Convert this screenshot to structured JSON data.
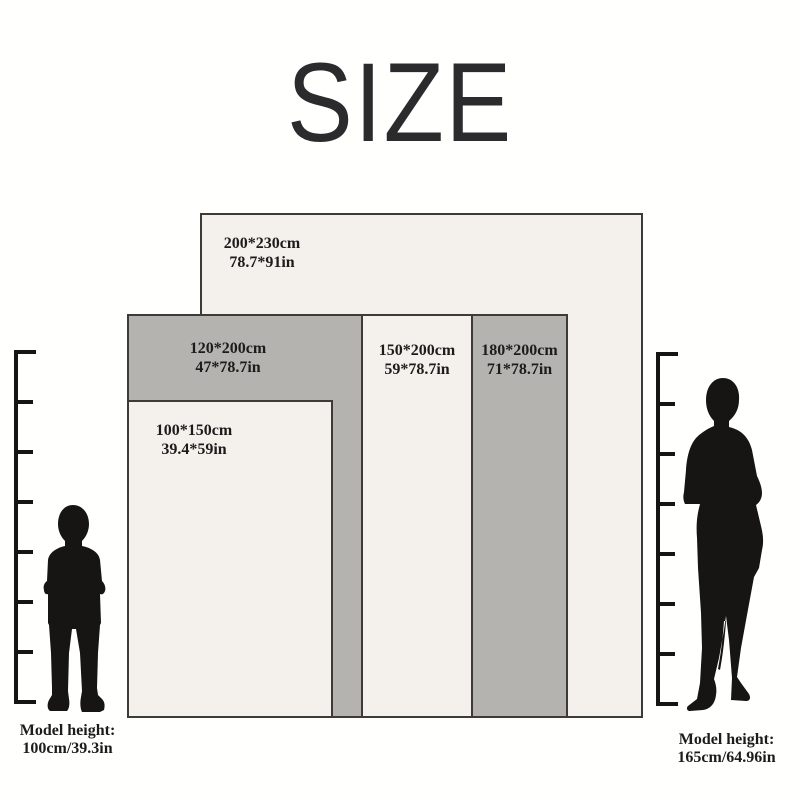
{
  "title": "SIZE",
  "sizes": [
    {
      "id": "200x230",
      "cm": "200*230cm",
      "inch": "78.7*91in"
    },
    {
      "id": "120x200",
      "cm": "120*200cm",
      "inch": "47*78.7in"
    },
    {
      "id": "100x150",
      "cm": "100*150cm",
      "inch": "39.4*59in"
    },
    {
      "id": "150x200",
      "cm": "150*200cm",
      "inch": "59*78.7in"
    },
    {
      "id": "180x200",
      "cm": "180*200cm",
      "inch": "71*78.7in"
    }
  ],
  "models": {
    "left": {
      "label": "Model height:",
      "value": "100cm/39.3in"
    },
    "right": {
      "label": "Model height:",
      "value": "165cm/64.96in"
    }
  },
  "palette": {
    "background": "#fffffe",
    "panel_light": "#f4f0eb",
    "panel_gray": "#b5b3af",
    "panel_border": "#3d3b38",
    "text": "#1c1c1c",
    "title": "#2b2b2e",
    "silhouette": "#171514"
  }
}
